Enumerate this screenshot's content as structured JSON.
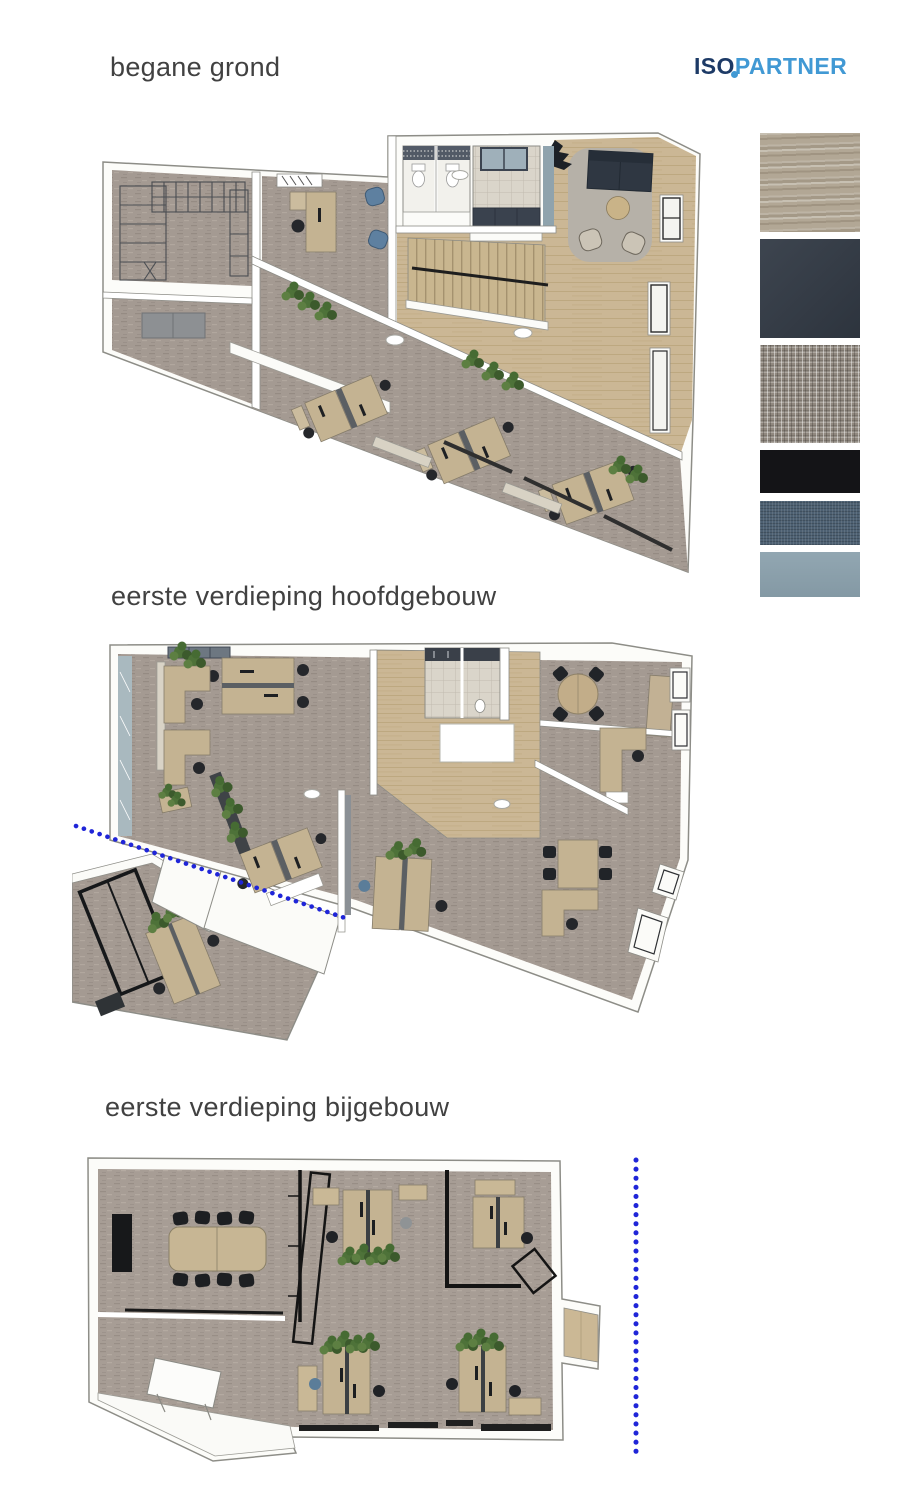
{
  "logo": {
    "iso": "ISO",
    "partner": "PARTNER",
    "iso_color": "#1d3a66",
    "partner_color": "#4199d4"
  },
  "plans": [
    {
      "id": "begane-grond",
      "label": "begane grond"
    },
    {
      "id": "eerste-verdieping-hoofdgebouw",
      "label": "eerste verdieping hoofdgebouw"
    },
    {
      "id": "eerste-verdieping-bijgebouw",
      "label": "eerste verdieping bijgebouw"
    }
  ],
  "materials": [
    {
      "name": "wood laminate",
      "color": "#b2a795"
    },
    {
      "name": "charcoal panel",
      "color": "#333b46"
    },
    {
      "name": "speckled carpet",
      "color": "#90887f"
    },
    {
      "name": "black fabric",
      "color": "#141417"
    },
    {
      "name": "denim blue fabric",
      "color": "#4d6072"
    },
    {
      "name": "steel blue",
      "color": "#8ba1ad"
    }
  ],
  "section_line_color": "#1f25d8"
}
